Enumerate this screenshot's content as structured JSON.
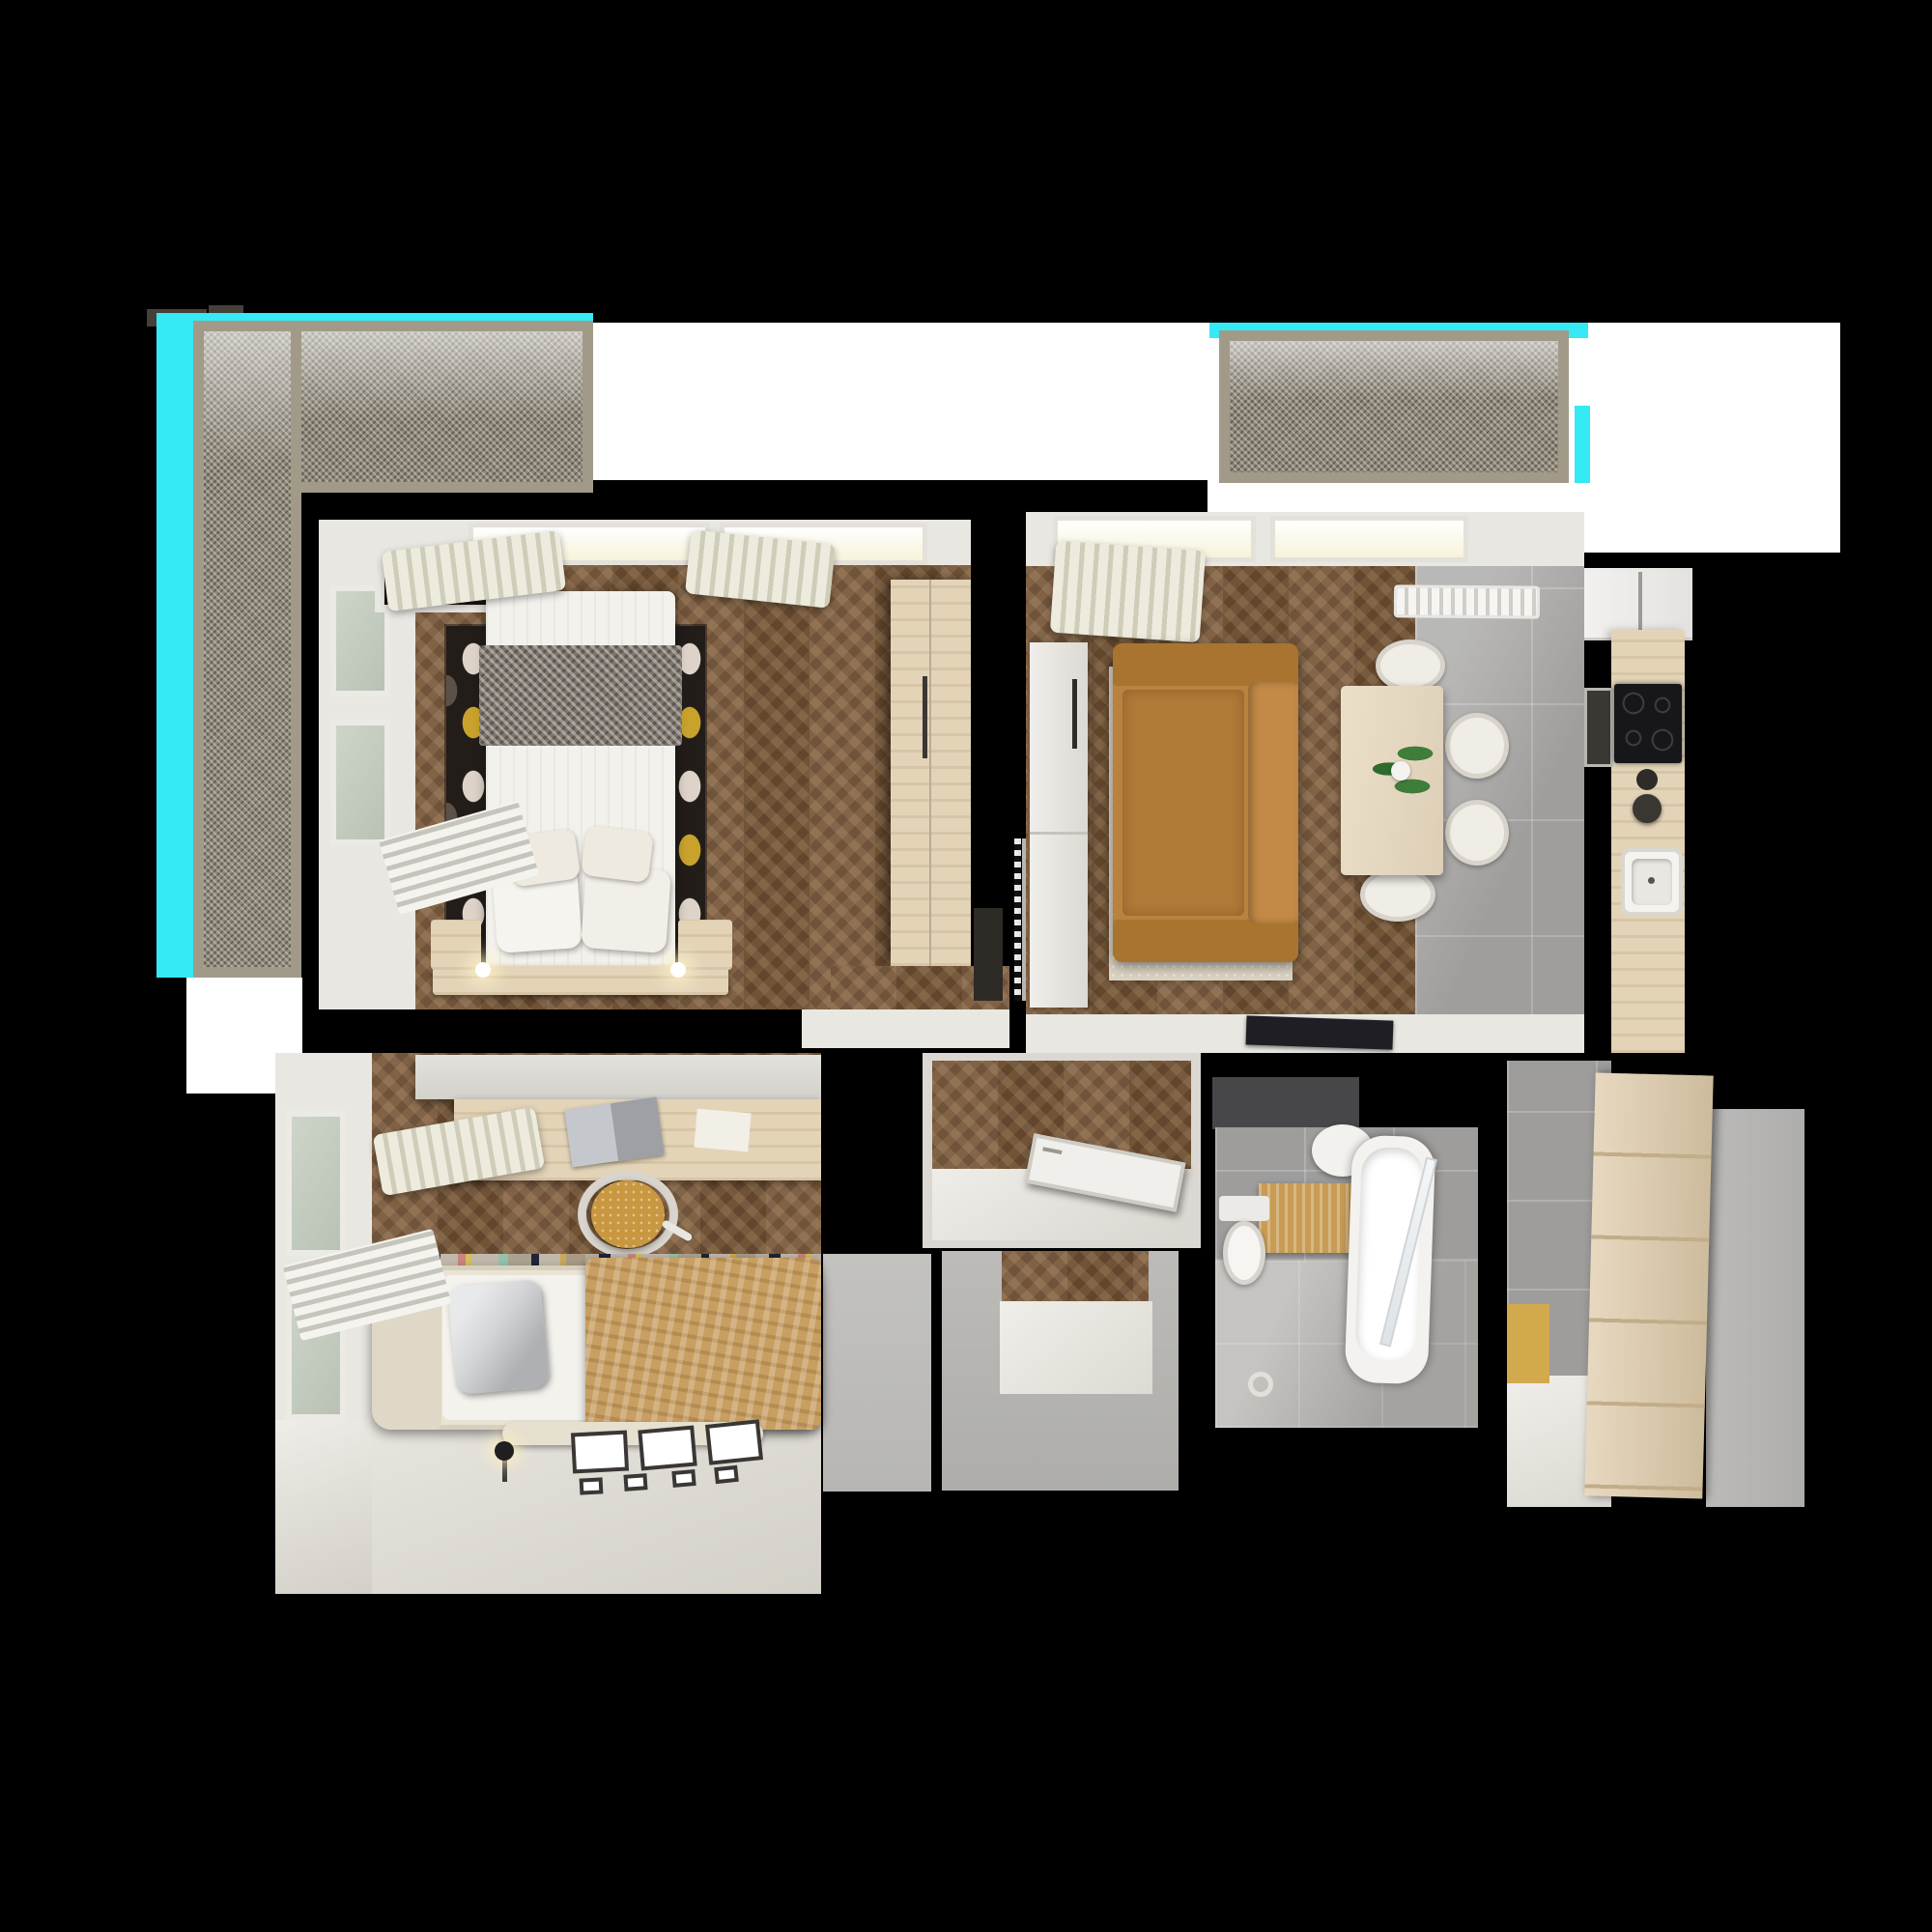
{
  "scene": {
    "title": "apartment-floor-plan-3d-top-down-render",
    "background": "#000000",
    "rooms": [
      {
        "id": "balcony-left",
        "furniture": [
          "mesh-screen-railing",
          "cyan-clip-highlight"
        ]
      },
      {
        "id": "balcony-right",
        "furniture": [
          "mesh-screen-railing",
          "cyan-clip-highlight"
        ]
      },
      {
        "id": "master-bedroom",
        "furniture": [
          "double-bed",
          "herringbone-blanket",
          "pillows",
          "polka-dot-rug",
          "tv-panel",
          "wardrobe",
          "nightstands",
          "window",
          "curtains",
          "radiator"
        ]
      },
      {
        "id": "living-room",
        "furniture": [
          "camel-sofa",
          "cream-rug",
          "dining-table",
          "potted-plant",
          "four-chairs",
          "sideboard",
          "radiator-vent",
          "tv-tablet-on-ledge",
          "curtain",
          "window"
        ]
      },
      {
        "id": "kitchen",
        "furniture": [
          "white-cabinets",
          "wood-countertop",
          "induction-cooktop",
          "built-in-oven",
          "sink",
          "faucet"
        ]
      },
      {
        "id": "hallway",
        "furniture": [
          "open-white-door",
          "wood-floor"
        ]
      },
      {
        "id": "bathroom",
        "furniture": [
          "bathtub",
          "glass-screen",
          "toilet",
          "round-basin",
          "ochre-towel",
          "grey-tile-walls"
        ]
      },
      {
        "id": "entry-hall",
        "furniture": [
          "plank-wardrobe",
          "ochre-mat",
          "grey-tile-wall"
        ]
      },
      {
        "id": "kids-bedroom",
        "furniture": [
          "single-bed",
          "tan-blanket",
          "silver-pillow",
          "desk",
          "laptop",
          "mustard-office-chair",
          "wall-shelf",
          "striped-rug",
          "floor-lamp",
          "picture-frames",
          "window",
          "curtains",
          "radiator"
        ]
      },
      {
        "id": "storage-closet",
        "furniture": []
      }
    ]
  },
  "palette": {
    "bg": "#000000",
    "cyan": "#35e9f5",
    "white": "#ffffff",
    "wallLight": "#e9e7e2",
    "meshBase": "#8f8879",
    "meshFrame": "#a29a89",
    "woodFloor": "#7b5a3b",
    "woodLight": "#e3d4b8",
    "tileGrey": "#a9a8a6",
    "tileWall": "#9e9d9b",
    "rugCream": "#d9d2c1",
    "rugBlack": "#221d19",
    "rugGold": "#c9a22c",
    "sofaCamel": "#b9823e",
    "sofaCamelDark": "#a8742f",
    "blanketTan": "#c89f62",
    "chairMustard": "#c9973f",
    "towelOchre": "#c89c55",
    "matOchre": "#d3a94e",
    "doorGrey": "#b8b7b3",
    "darkPanel": "#474749",
    "tvDark": "#2c211c",
    "cooktopBlack": "#17171a",
    "floorCream": "#dfdcd5",
    "bathFloor": "#b3b1ad",
    "greyBlock": "#b7b6b3",
    "wardrobeWood": "#dfcbaa",
    "bedFrameCream": "#e9e3d4",
    "pillowSilver": "#d3d4d6",
    "plantGreen": "#3f7d3a",
    "glowWarm": "#f7f3da"
  }
}
